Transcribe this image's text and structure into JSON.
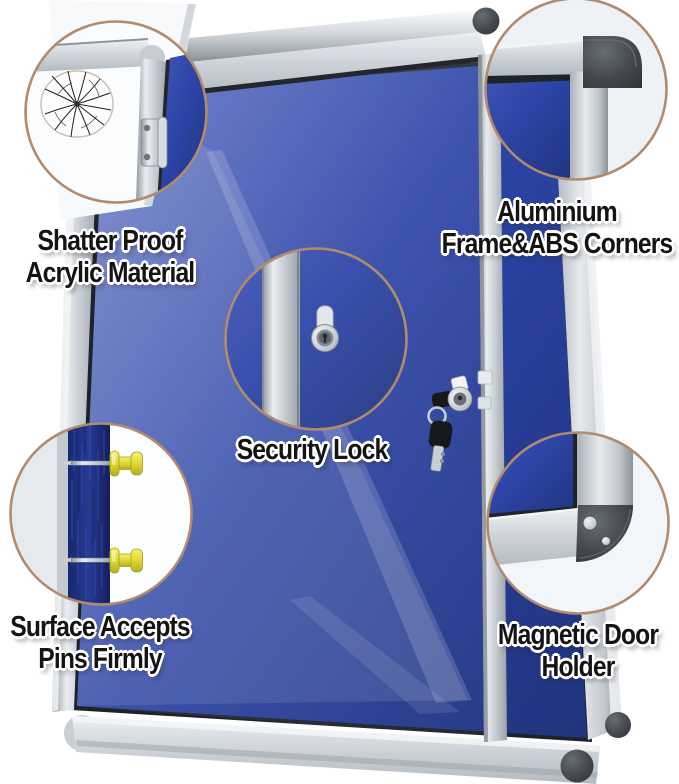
{
  "product": {
    "type": "lockable-notice-board-illustration",
    "features": [
      {
        "id": "shatter-proof",
        "label": "Shatter Proof\nAcrylic Material",
        "icon": "cracked-acrylic-magnifier-icon"
      },
      {
        "id": "aluminium-frame",
        "label": "Aluminium\nFrame&ABS Corners",
        "icon": "frame-corner-magnifier-icon"
      },
      {
        "id": "security-lock",
        "label": "Security Lock",
        "icon": "lock-cylinder-magnifier-icon"
      },
      {
        "id": "pin-surface",
        "label": "Surface Accepts\nPins Firmly",
        "icon": "pushpin-magnifier-icon"
      },
      {
        "id": "magnetic-holder",
        "label": "Magnetic Door\nHolder",
        "icon": "corner-magnet-magnifier-icon"
      }
    ]
  },
  "features": [
    {
      "label": "Shatter Proof\nAcrylic Material"
    },
    {
      "label": "Aluminium\nFrame&ABS Corners"
    },
    {
      "label": "Security Lock"
    },
    {
      "label": "Surface Accepts\nPins Firmly"
    },
    {
      "label": "Magnetic Door\nHolder"
    }
  ],
  "colors": {
    "background": "#ffffff",
    "felt_blue": "#2c44a6",
    "felt_blue_light": "#4059bb",
    "felt_blue_dark": "#20347e",
    "felt_navy_section": "#1d2f7c",
    "frame_silver": "#c9cfd5",
    "frame_silver_light": "#eef1f4",
    "abs_corner_gray": "#42474d",
    "magnifier_ring_tan": "#b28a6c",
    "pushpin_yellow": "#e2dc39",
    "key_black": "#17181a",
    "label_text": "#141414"
  }
}
